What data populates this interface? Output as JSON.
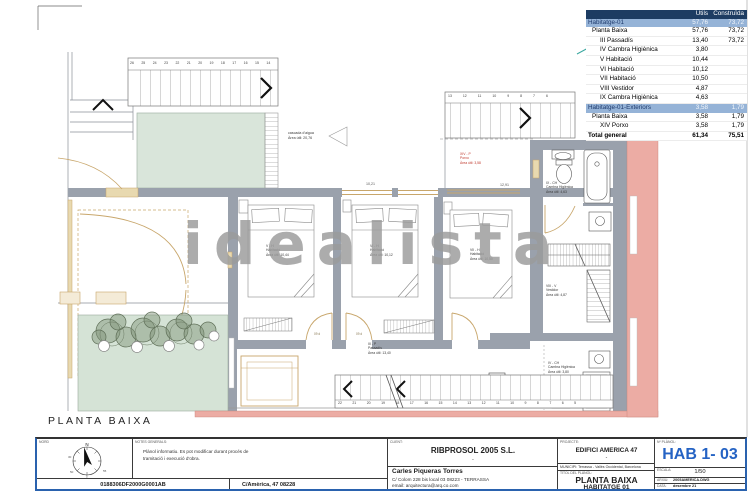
{
  "colors": {
    "accent_blue": "#2A62AE",
    "sheet_number_blue": "#2563C4",
    "table_header_bg": "#1D3C62",
    "table_highlight_bg": "#95B3D7",
    "wall_gray": "#9AA1AC",
    "pool_green": "#D9E5DA",
    "garden_green": "#D5E3D6",
    "neighbor_salmon": "#ECACA4",
    "wood_tan": "#C8A66B",
    "watermark_gray": "#9B9B9B",
    "porxo_red": "#C03A2E"
  },
  "watermark_text": "idealista",
  "plan": {
    "title": "PLANTA BAIXA",
    "labels": {
      "pool": "cascada d'aigua\nÀrea útil:  20,76",
      "porxo": "XIV - P\nPorxo\nÀrea útil:  3,58",
      "bath_top": "IX - CH\nCambra Higiènica\nÀrea útil:  4,63",
      "vestidor": "VIII - V\nVestidor\nÀrea útil:  4,87",
      "bath_bottom": "IV - CH\nCambra Higiènica\nÀrea útil:  3,80",
      "bedroom1": "V - H\nHabitació\nÀrea útil:  10,44",
      "bedroom2": "VI - H\nHabitació\nÀrea útil:  10,12",
      "bedroom3": "VII - H\nHabitació\nÀrea útil:  10,50",
      "corridor": "III - P\nPassadís\nÀrea útil:  13,40",
      "dim1": "10,21",
      "dim2": "12,91",
      "door_tag1": "09 d",
      "door_tag2": "09 d"
    },
    "stairs": {
      "top": "26 25 24 23 22 21 20 19 18 17 16 15 14",
      "top2": "13 12 11 10 9 8 7 6",
      "bottom": "22 21 20 19 18 17 16 15 14 13 12 11 10 9 8 7 6 5"
    }
  },
  "area_table": {
    "col_utils": "Útils",
    "col_construida": "Construïda",
    "rows": [
      {
        "label": "Habitatge-01",
        "utils": "57,76",
        "construida": "73,72"
      },
      {
        "label": "Planta Baixa",
        "utils": "57,76",
        "construida": "73,72"
      },
      {
        "label": "III Passadís",
        "utils": "13,40",
        "construida": "73,72"
      },
      {
        "label": "IV Cambra Higiènica",
        "utils": "3,80",
        "construida": ""
      },
      {
        "label": "V Habitació",
        "utils": "10,44",
        "construida": ""
      },
      {
        "label": "VI Habitació",
        "utils": "10,12",
        "construida": ""
      },
      {
        "label": "VII Habitació",
        "utils": "10,50",
        "construida": ""
      },
      {
        "label": "VIII Vestidor",
        "utils": "4,87",
        "construida": ""
      },
      {
        "label": "IX Cambra Higiènica",
        "utils": "4,63",
        "construida": ""
      },
      {
        "label": "Habitatge-01-Exteriors",
        "utils": "3,58",
        "construida": "1,79"
      },
      {
        "label": "Planta Baixa",
        "utils": "3,58",
        "construida": "1,79"
      },
      {
        "label": "XIV Porxo",
        "utils": "3,58",
        "construida": "1,79"
      },
      {
        "label": "Total general",
        "utils": "61,34",
        "construida": "75,51"
      }
    ]
  },
  "title_block": {
    "compass": {
      "label": "NORD",
      "north": "N",
      "n1": "30",
      "n2": "50",
      "n3": "5",
      "n4": "55"
    },
    "notes_label": "NOTES GENERALS:",
    "notes_text": "Plànol informatiu. Es pot modificar durant procés de\ntramitació i execució d'obra.",
    "cadastral_ref": "0188306DF2000G0001AB",
    "address": "C/Amèrica, 47 08228",
    "client_label": "CLIENT:",
    "client_name": "RIBPROSOL 2005 S.L.",
    "client_dash": "-",
    "architect_name": "Carles Piqueras Torres",
    "architect_address": "C/ Colom 228 bis local 03   08223 - TERRASSA",
    "architect_email": "email: arquitectura@arq.co.com",
    "project_label": "PROJECTE:",
    "project_name": "EDIFICI AMERICA 47",
    "project_dash": "-",
    "municipality": "MUNICIPI:  Terrassa - Vallès Occidental, Barcelona",
    "plan_title_label": "TÍTOL DEL PLÀNOL:",
    "plan_title": "PLANTA BAIXA",
    "plan_subtitle": "HABITATGE 01",
    "sheet_label": "Nº PLÀNOL:",
    "sheet_number": "HAB 1- 03",
    "scale_label": "ESCALA:",
    "scale": "1/50",
    "file_label": "ARXIU:",
    "file": "2005AMERICA.DWG",
    "date_label": "DATA:",
    "date": "desembre 21"
  }
}
